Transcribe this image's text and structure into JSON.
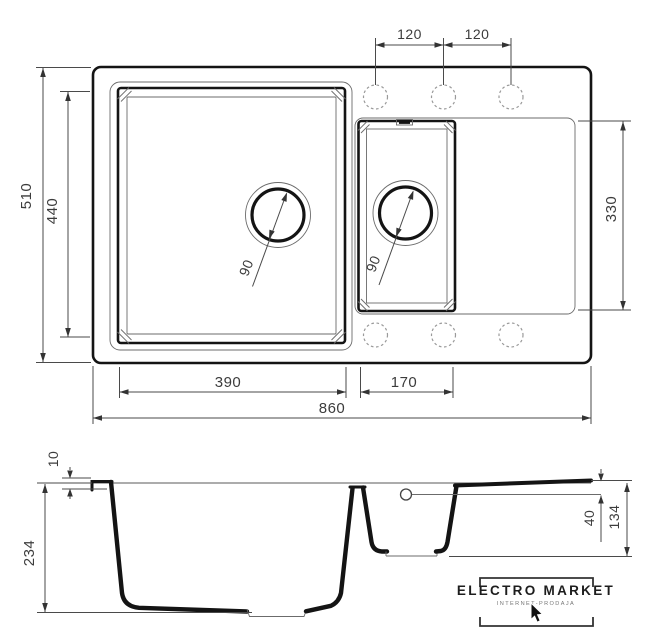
{
  "drawing_type": "kitchen sink technical drawing, plan and section views",
  "dims": {
    "overall_width": "860",
    "overall_depth": "510",
    "bowls_inner_depth": "440",
    "main_bowl_width": "390",
    "half_bowl_width": "170",
    "recess_length": "330",
    "hole_spacing_left": "120",
    "hole_spacing_right": "120",
    "main_drain_diameter": "90",
    "half_drain_diameter": "90",
    "rim_thickness": "10",
    "main_bowl_depth": "234",
    "overflow_drop": "40",
    "half_bowl_depth": "134"
  },
  "branding": {
    "name": "ELECTRO MARKET",
    "subtitle": "INTERNET-PRODAJA"
  }
}
